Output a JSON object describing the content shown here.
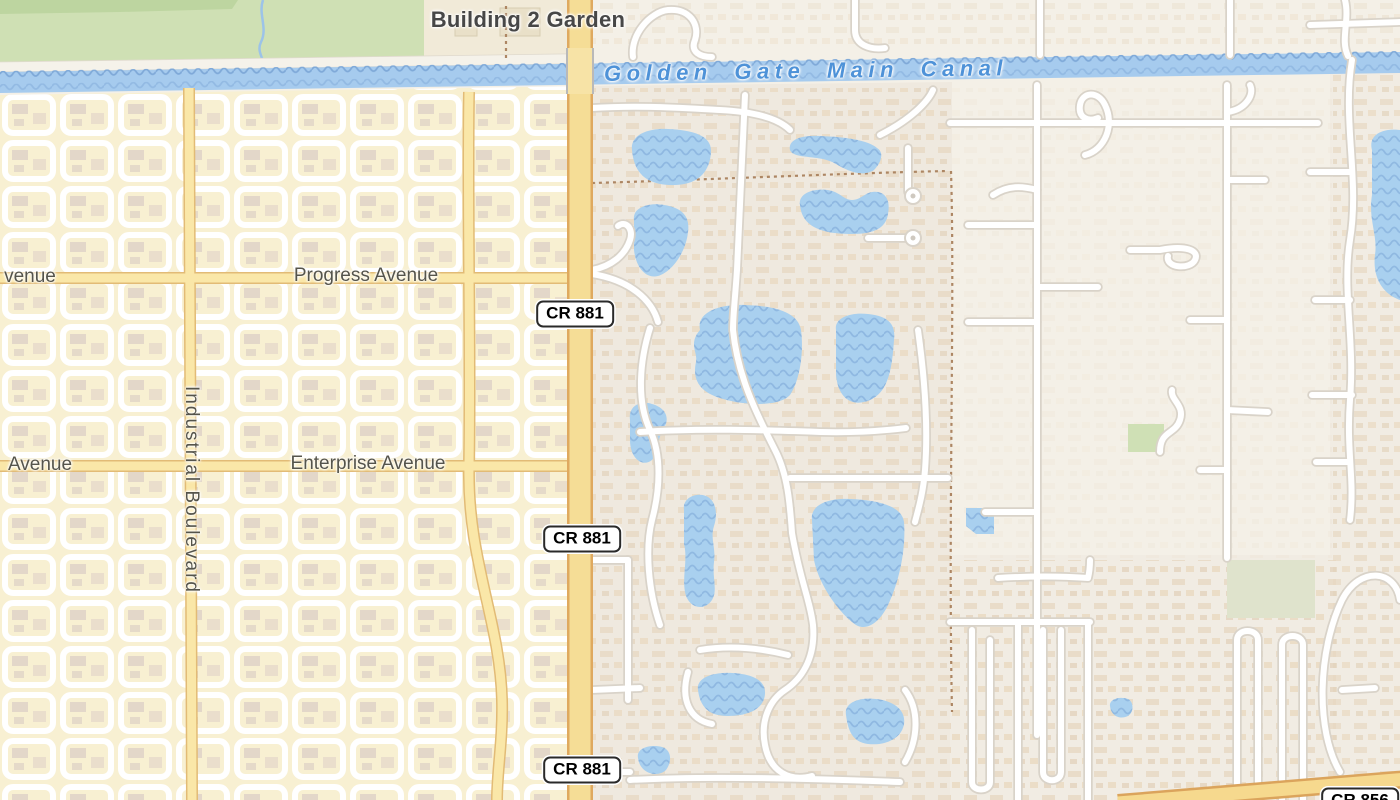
{
  "map": {
    "labels": {
      "poi_garden": "Building 2 Garden",
      "canal": "Golden Gate Main Canal",
      "road_progress": "Progress Avenue",
      "road_enterprise": "Enterprise Avenue",
      "road_industrial": "Industrial Boulevard",
      "road_partial_top": "venue",
      "road_partial_bottom": "Avenue"
    },
    "shields": {
      "cr881": "CR 881",
      "cr856": "CR 856"
    },
    "colors": {
      "urban_left_bg": "#f8f0d2",
      "residential_bg": "#efe9df",
      "plain_bg": "#f4f0e7",
      "park_green": "#cfe0b4",
      "park_green_dark": "#bdd5a0",
      "water_blue": "#a6cbee",
      "water_wave": "#7fa9d8",
      "canal_label_blue": "#4e92d8",
      "primary_road_fill": "#f5dd96",
      "primary_road_casing": "#dfa95f",
      "secondary_road_fill": "#fae7a8",
      "secondary_road_casing": "#e2bb76",
      "street_white": "#ffffff",
      "street_casing": "#d9d3c9",
      "building_tan": "#e5d7c6",
      "boundary_dash": "#ad8663",
      "label_gray": "#55544b"
    }
  }
}
